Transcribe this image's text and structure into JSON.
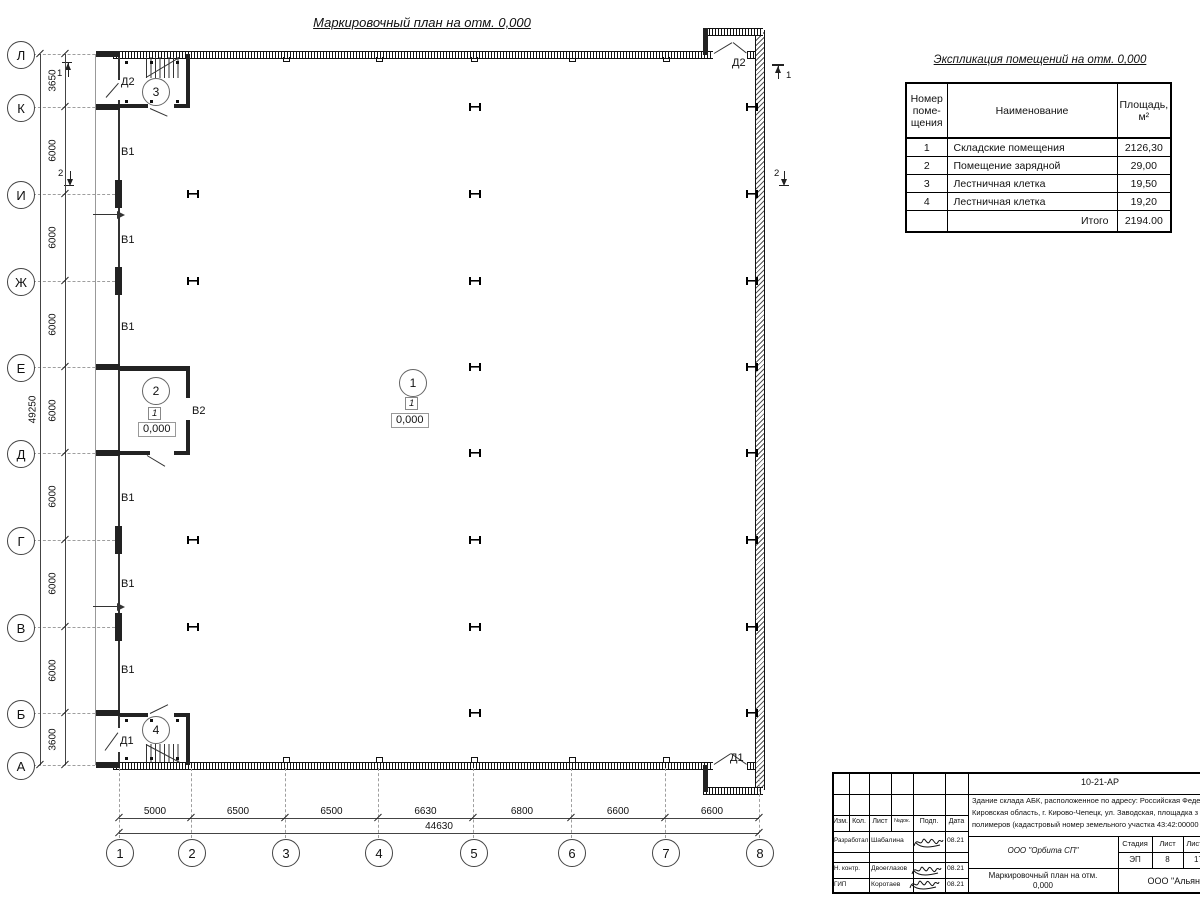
{
  "drawing": {
    "title": "Маркировочный план на отм. 0,000",
    "axes": {
      "rows": [
        "Л",
        "К",
        "И",
        "Ж",
        "Е",
        "Д",
        "Г",
        "В",
        "Б",
        "А"
      ],
      "cols": [
        "1",
        "2",
        "3",
        "4",
        "5",
        "6",
        "7",
        "8"
      ],
      "row_dims": [
        "3650",
        "6000",
        "6000",
        "6000",
        "6000",
        "6000",
        "6000",
        "6000",
        "3600"
      ],
      "row_total": "49250",
      "col_dims": [
        "5000",
        "6500",
        "6500",
        "6630",
        "6800",
        "6600",
        "6600"
      ],
      "col_total": "44630"
    },
    "markers": {
      "room1": {
        "number": "1",
        "floor": "1",
        "elevation": "0,000"
      },
      "room2": {
        "number": "2",
        "floor": "1",
        "elevation": "0,000"
      },
      "room3": {
        "number": "3"
      },
      "room4": {
        "number": "4"
      }
    },
    "doors": {
      "top_left": "Д2",
      "top_right": "Д2",
      "bottom_left": "Д1",
      "bottom_right": "Д1"
    },
    "window_label": "В1",
    "gate_label": "В2",
    "section_marks": [
      "1",
      "2"
    ]
  },
  "explication": {
    "title": "Экспликация помещений на отм. 0,000",
    "headers": [
      "Номер\nпоме-\nщения",
      "Наименование",
      "Площадь,\nм²"
    ],
    "rows": [
      [
        "1",
        "Складские помещения",
        "2126,30"
      ],
      [
        "2",
        "Помещение зарядной",
        "29,00"
      ],
      [
        "3",
        "Лестничная клетка",
        "19,50"
      ],
      [
        "4",
        "Лестничная клетка",
        "19,20"
      ]
    ],
    "total_label": "Итого",
    "total_value": "2194.00"
  },
  "stamp": {
    "doc_number": "10-21-АР",
    "description_lines": [
      "Здание склада АБК, расположенное по адресу: Российская Феде",
      "Кировская область, г. Кирово-Чепецк, ул. Заводская, площадка з",
      "полимеров (кадастровый номер земельного участка 43:42:00000"
    ],
    "header_cells": [
      "Изм.",
      "Кол.",
      "Лист",
      "№док.",
      "Подп.",
      "Дата"
    ],
    "people": [
      {
        "role": "Разработал",
        "name": "Шабалина",
        "date": "08.21"
      },
      {
        "role": "Н. контр.",
        "name": "Двоеглазов",
        "date": "08.21"
      },
      {
        "role": "ГИП",
        "name": "Коротаев",
        "date": "08.21"
      }
    ],
    "org": "ООО \"Орбита СП\"",
    "stage_headers": [
      "Стадия",
      "Лист",
      "Листов"
    ],
    "stage_values": [
      "ЭП",
      "8",
      "17"
    ],
    "sheet_title_line1": "Маркировочный план на отм.",
    "sheet_title_line2": "0,000",
    "company": "ООО \"Альянс"
  }
}
